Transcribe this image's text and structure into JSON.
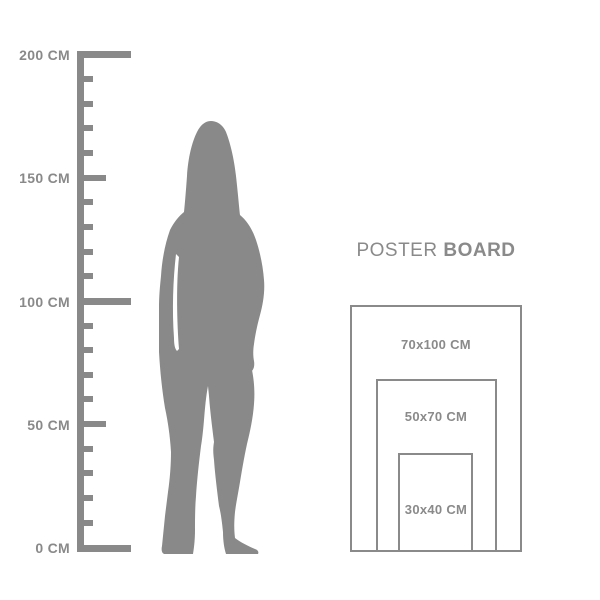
{
  "colors": {
    "foreground_gray": "#898989",
    "border_gray": "#8a8a8a",
    "background": "#ffffff"
  },
  "ruler": {
    "unit": "CM",
    "min_cm": 0,
    "max_cm": 200,
    "small_tick_interval_cm": 10,
    "labeled_interval_cm": 50,
    "labels": [
      {
        "text": "200 CM",
        "cm": 200
      },
      {
        "text": "150 CM",
        "cm": 150
      },
      {
        "text": "100 CM",
        "cm": 100
      },
      {
        "text": "50 CM",
        "cm": 50
      },
      {
        "text": "0 CM",
        "cm": 0
      }
    ]
  },
  "figure": {
    "icon": "woman-silhouette-icon",
    "approx_height_cm": 173
  },
  "poster_board": {
    "title_regular": "POSTER",
    "title_bold": "BOARD",
    "sizes": [
      {
        "label": "70x100 CM",
        "width_cm": 70,
        "height_cm": 100
      },
      {
        "label": "50x70 CM",
        "width_cm": 50,
        "height_cm": 70
      },
      {
        "label": "30x40 CM",
        "width_cm": 30,
        "height_cm": 40
      }
    ]
  }
}
